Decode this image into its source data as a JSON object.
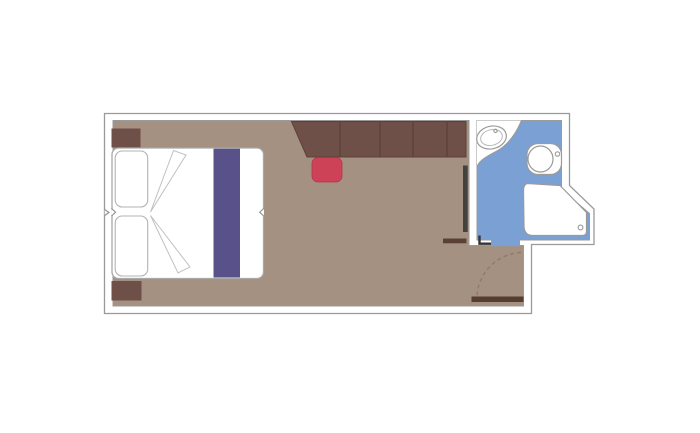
{
  "plan": {
    "kind": "cabin-floorplan",
    "rooms": [
      "main-cabin",
      "bathroom",
      "entry-corridor"
    ],
    "furniture": [
      "double-bed",
      "pillows",
      "bed-runner",
      "nightstand-top",
      "nightstand-bottom",
      "wardrobe-cabinet-row",
      "stool",
      "mirror-strip"
    ],
    "bathroom_fixtures": [
      "sink",
      "toilet",
      "shower"
    ],
    "doors": [
      "cabin-entry-door",
      "bathroom-door",
      "entry-door-swing-arc"
    ]
  },
  "colors": {
    "background": "#ffffff",
    "wall_fill": "#ffffff",
    "wall_line": "#9a9a9a",
    "floor": "#a49181",
    "bathroom_floor": "#7aa0d4",
    "furniture_brown": "#6f5048",
    "furniture_divider": "#5c4038",
    "furniture_edge": "#5c4139",
    "door_brown": "#573c30",
    "bar_brown": "#5a4036",
    "mirror_dark": "#45413c",
    "stool_red": "#ce4257",
    "stool_red_edge": "#b53448",
    "bed_runner_purple": "#595189",
    "swing_arc": "#8d7c6e",
    "jamb_dark": "#333333"
  }
}
